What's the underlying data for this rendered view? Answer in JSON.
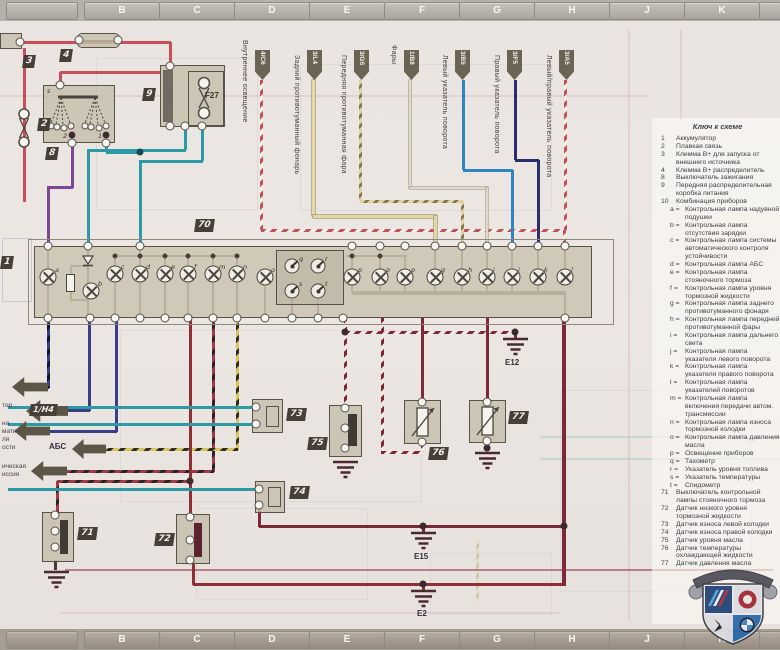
{
  "grid": {
    "top": [
      "B",
      "C",
      "D",
      "E",
      "F",
      "G",
      "H",
      "J",
      "K"
    ],
    "bottom": [
      "B",
      "C",
      "D",
      "E",
      "F",
      "G",
      "H",
      "J",
      "K"
    ]
  },
  "top_labels": [
    {
      "label": "Внутреннее освещение",
      "tag": "4/C6"
    },
    {
      "label": "Задний противотуманный фонарь",
      "tag": "3/L4"
    },
    {
      "label": "Передняя противотуманная фара",
      "tag": "3/G5"
    },
    {
      "label": "Фары",
      "tag": "1/B8"
    },
    {
      "label": "Левый указатель поворота",
      "tag": "3/B5"
    },
    {
      "label": "Правый указатель поворота",
      "tag": "3/F5"
    },
    {
      "label": "Левый/правый указатель поворота",
      "tag": "3/A5"
    }
  ],
  "components": {
    "battery": "1",
    "fusible_link": "2",
    "jump_terminal": "3",
    "b_plus": "4",
    "ignition_switch": "8",
    "power_box": "9",
    "fuse_f27": "F27",
    "cluster": "70",
    "switch_71": "71",
    "sensor_72": "72",
    "sensor_73": "73",
    "sensor_74": "74",
    "sensor_75": "75",
    "sensor_76": "76",
    "sensor_77": "77"
  },
  "grounds": {
    "e12": "E12",
    "e15": "E15",
    "e2": "E2"
  },
  "left_labels": {
    "ref_tag": "1/Н4",
    "abs": "АБС",
    "fragments": [
      "тор",
      "на",
      "матич.",
      "ля",
      "ости",
      "ическая",
      "иссия"
    ]
  },
  "pins": {
    "a": "a",
    "b": "b",
    "c": "c",
    "d": "d",
    "e": "e",
    "f": "f",
    "m": "m",
    "n": "n",
    "o": "o",
    "p1": "p",
    "p2": "p",
    "p3": "p",
    "g": "g",
    "h": "h",
    "i": "i",
    "j": "j",
    "k": "k",
    "l": "l",
    "q": "q",
    "r": "r",
    "s": "s",
    "t": "t",
    "sw_s": "s",
    "sw_1": "1",
    "sw_2": "2"
  },
  "legend": {
    "title": "Ключ к схеме",
    "items": [
      {
        "num": "1",
        "text": "Аккумулятор"
      },
      {
        "num": "2",
        "text": "Плавкая связь"
      },
      {
        "num": "3",
        "text": "Клемма B+ для запуска от внешнего источника"
      },
      {
        "num": "4",
        "text": "Клемма B+ распределитель"
      },
      {
        "num": "8",
        "text": "Выключатель зажигания"
      },
      {
        "num": "9",
        "text": "Передняя распределительная коробка питания"
      },
      {
        "num": "10",
        "text": "Комбинация приборов"
      },
      {
        "num": "a =",
        "text": "Контрольная лампа надувной подушки"
      },
      {
        "num": "b =",
        "text": "Контрольная лампа отсутствия зарядки"
      },
      {
        "num": "c =",
        "text": "Контрольная лампа системы автоматического контроля устойчивости"
      },
      {
        "num": "d =",
        "text": "Контрольная лампа АБС"
      },
      {
        "num": "e =",
        "text": "Контрольная лампа стояночного тормоза"
      },
      {
        "num": "f =",
        "text": "Контрольная лампа уровня тормозной жидкости"
      },
      {
        "num": "g =",
        "text": "Контрольная лампа заднего противотуманного фонаря"
      },
      {
        "num": "h =",
        "text": "Контрольная лампа передней противотуманной фары"
      },
      {
        "num": "i =",
        "text": "Контрольная лампа дальнего света"
      },
      {
        "num": "j =",
        "text": "Контрольная лампа указателя левого поворота"
      },
      {
        "num": "k =",
        "text": "Контрольная лампа указателя правого поворота"
      },
      {
        "num": "l =",
        "text": "Контрольная лампа указателей поворотов"
      },
      {
        "num": "m =",
        "text": "Контрольная лампа включения передачи автом. трансмиссии"
      },
      {
        "num": "n =",
        "text": "Контрольная лампа износа тормозной колодки"
      },
      {
        "num": "o =",
        "text": "Контрольная лампа давления масла"
      },
      {
        "num": "p =",
        "text": "Освещение приборов"
      },
      {
        "num": "q =",
        "text": "Тахометр"
      },
      {
        "num": "r =",
        "text": "Указатель уровня топлива"
      },
      {
        "num": "s =",
        "text": "Указатель температуры"
      },
      {
        "num": "t =",
        "text": "Спидометр"
      },
      {
        "num": "71",
        "text": "Выключатель контрольной лампы стояночного тормоза"
      },
      {
        "num": "72",
        "text": "Датчик низкого уровня тормозной жидкости"
      },
      {
        "num": "73",
        "text": "Датчик износа левой колодки"
      },
      {
        "num": "74",
        "text": "Датчик износа правой колодки"
      },
      {
        "num": "75",
        "text": "Датчик уровня масла"
      },
      {
        "num": "76",
        "text": "Датчик температуры охлаждающей жидкости"
      },
      {
        "num": "77",
        "text": "Датчик давления масла"
      }
    ]
  },
  "colors": {
    "red": "#c84f58",
    "purple": "#7b4796",
    "teal": "#2b9aa6",
    "navy": "#3a3f85",
    "blue": "#2e86c0",
    "dark_navy": "#2a2f6b",
    "maroon": "#7c2936",
    "cream": "#e2d8a8",
    "component_tan": "#c6beac",
    "label_box": "#453f37",
    "arrow": "#5c5646"
  }
}
